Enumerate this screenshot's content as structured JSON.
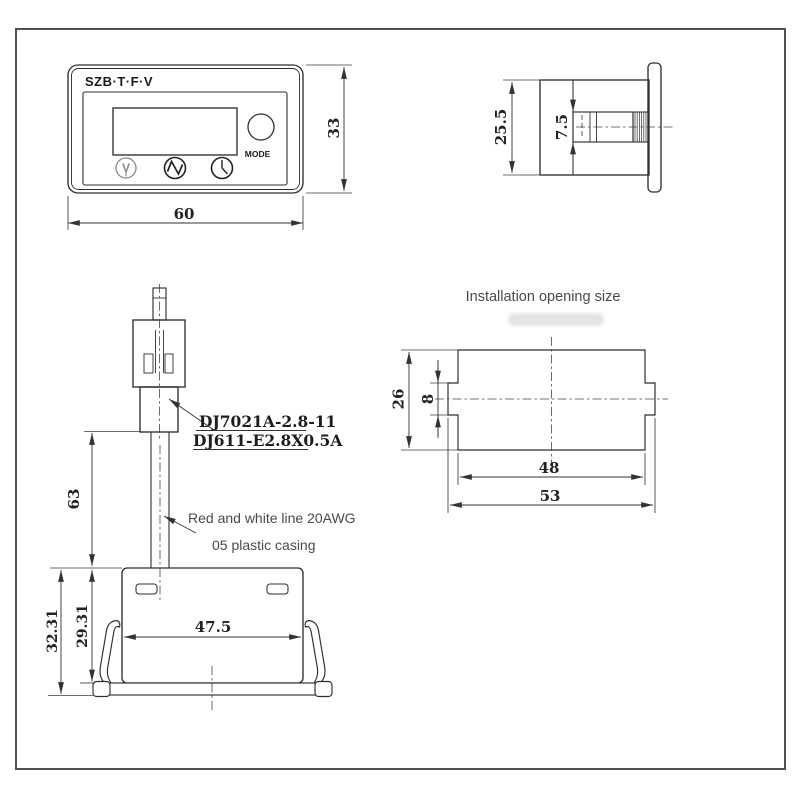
{
  "front_view": {
    "brand": "SZB·T·F·V",
    "mode_label": "MODE",
    "button_v_glyph": "V",
    "dim_width": "60",
    "dim_height": "33"
  },
  "side_view": {
    "dim_height": "25.5",
    "dim_plug_height": "7.5"
  },
  "installation": {
    "title": "Installation opening size",
    "dim_height": "26",
    "dim_notch_height": "8",
    "dim_inner_width": "48",
    "dim_outer_width": "53"
  },
  "harness_view": {
    "connector_label_1": "DJ7021A-2.8-11",
    "connector_label_2": "DJ611-E2.8X0.5A",
    "wire_label": "Red and white line 20AWG",
    "casing_label": "05 plastic casing",
    "dim_wire_length": "63",
    "dim_body_width": "47.5",
    "dim_depth_total": "32.31",
    "dim_depth_body": "29.31"
  },
  "colors": {
    "line": "#2f2f2f",
    "dimension": "#333333",
    "annotation": "#4a4a4a",
    "frame": "#4f4f4f"
  }
}
